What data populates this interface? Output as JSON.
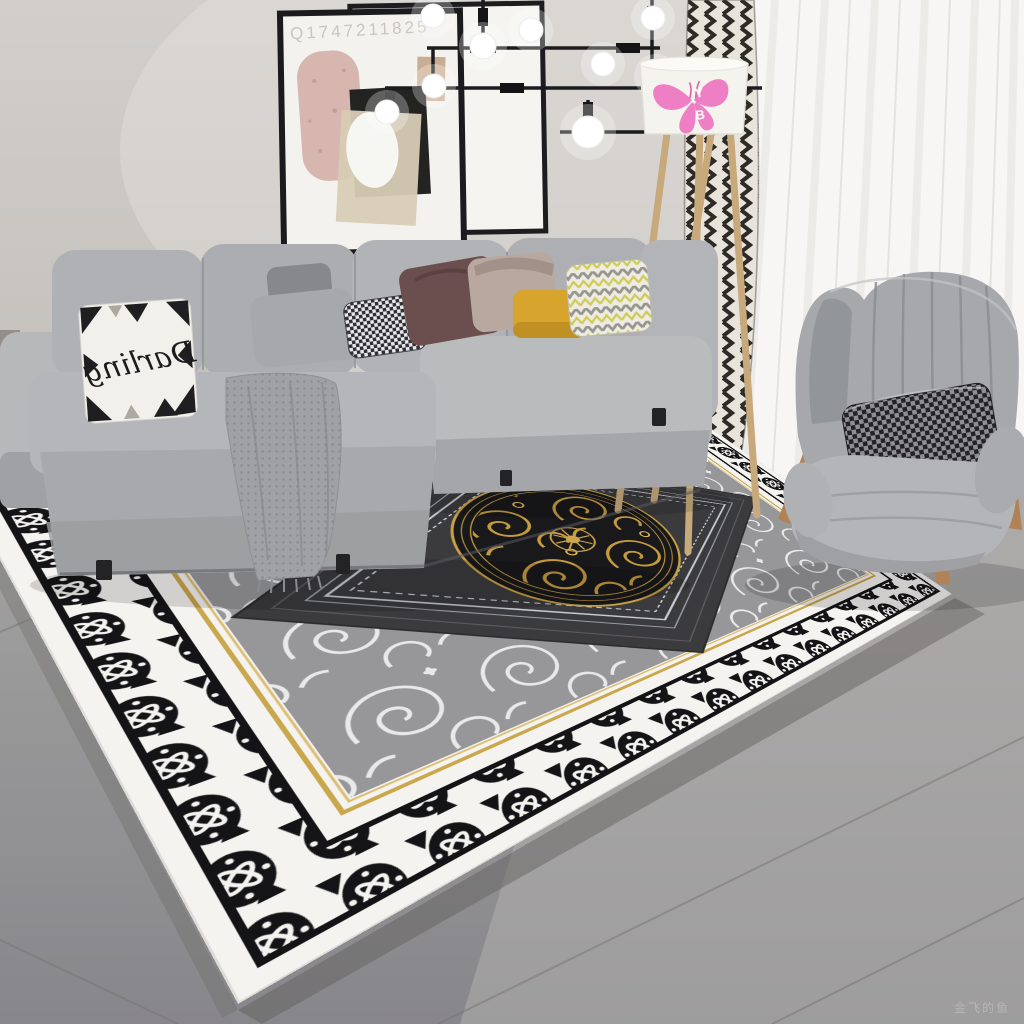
{
  "scene": {
    "description": "Living-room product photo of an ornate black, white, grey and gold medallion area rug with grey sectional sofa, wingback chair, tripod floor lamp, abstract wall art and black branch chandelier",
    "watermarks": {
      "frame_top_left": "Q1747211825",
      "bottom_right": "金飞的鱼"
    },
    "textiles": {
      "pillow_script": "Darling",
      "lamp_monogram_top": "Y",
      "lamp_monogram_bottom": "B"
    },
    "palette": {
      "wall": "#d0cdc9",
      "floor": "#9b9a98",
      "sofa_grey": "#aeafb2",
      "chair_grey": "#a6a8ab",
      "rug_white": "#f4f3f0",
      "rug_black": "#141417",
      "rug_field_grey": "#97979a",
      "rug_center_charcoal": "#3b3b3e",
      "rug_gold": "#c8a144",
      "accent_mustard": "#d7a42e",
      "accent_pink_butterfly": "#ee7fc4",
      "curtain_herringbone": "#2e2b27"
    }
  }
}
